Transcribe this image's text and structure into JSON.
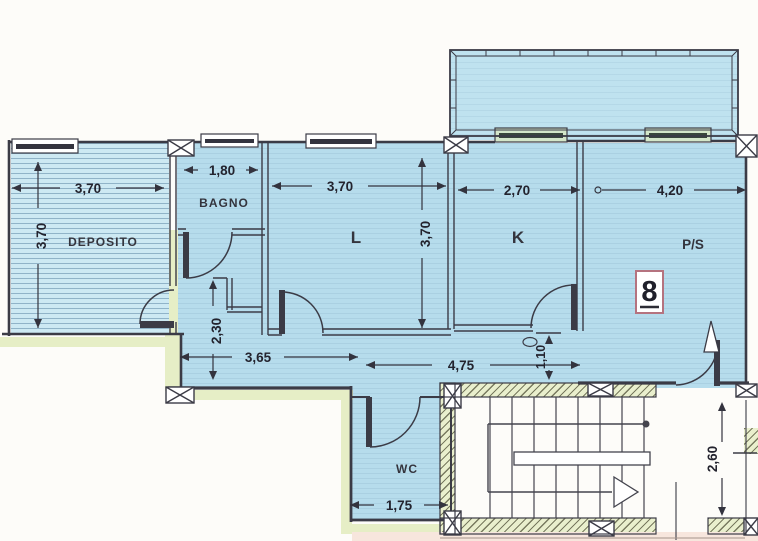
{
  "plan": {
    "rooms": {
      "deposito": "DEPOSITO",
      "bagno": "BAGNO",
      "soggiorno": "L",
      "cucina": "K",
      "ps": "P/S",
      "wc": "WC"
    },
    "unit_number": "8",
    "dims": {
      "deposito_w": "3,70",
      "deposito_d": "3,70",
      "bagno_w": "1,80",
      "soggiorno_w": "3,70",
      "soggiorno_d": "3,70",
      "cucina_w": "2,70",
      "ps_w": "4,20",
      "corridoio_d": "2,30",
      "corridoio_w": "3,65",
      "disimpegno_w": "4,75",
      "ingresso_d": "1,10",
      "wc_w": "1,75",
      "scala_d": "2,60"
    },
    "colors": {
      "room_fill": "#b6dcec",
      "wall": "#3b3b46",
      "lining": "#e6eec6",
      "badge_border": "#b5737f"
    }
  }
}
